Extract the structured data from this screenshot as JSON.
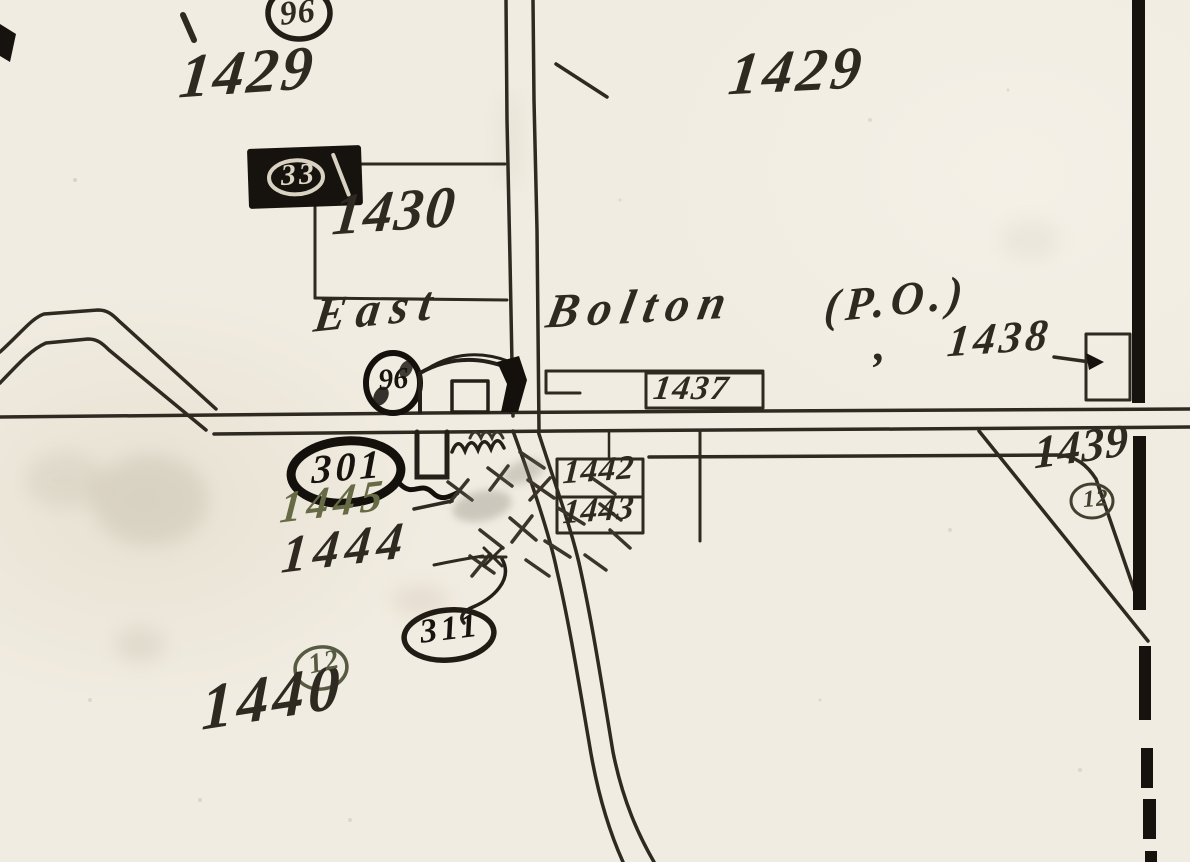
{
  "map": {
    "kind": "historic plat map scan",
    "place_label": {
      "word1": "East",
      "word2": "Bolton",
      "word3": "(P.O.)"
    },
    "parcel_numbers": {
      "p1429_nw": "1429",
      "p1429_ne": "1429",
      "p1430": "1430",
      "p1437": "1437",
      "p1438_comma": ",",
      "p1438": "1438",
      "p1439": "1439",
      "p1440": "1440",
      "p1442": "1442",
      "p1443": "1443",
      "p1444": "1444",
      "p1445": "1445"
    },
    "circled_markers": {
      "m96_top": "96",
      "m33_box": "33",
      "m96_po": "96",
      "m301": "301",
      "m311": "311",
      "m12_sw": "12",
      "m12_se": "12"
    },
    "colors": {
      "paper": "#f1ece1",
      "ink": "#2e2921",
      "heavy_ink": "#16130e",
      "olive_ink": "#666b45",
      "cream_ink": "#ddd5c3"
    }
  }
}
